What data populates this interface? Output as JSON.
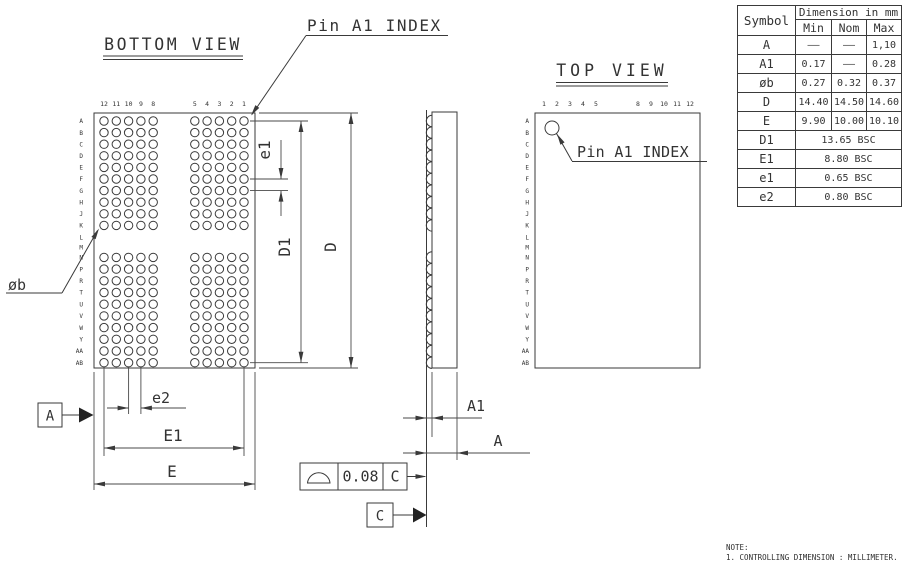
{
  "drawing": {
    "bottom_view_title": "BOTTOM VIEW",
    "top_view_title": "TOP VIEW",
    "pin_a1_index_bottom": "Pin A1 INDEX",
    "pin_a1_index_top": "Pin A1 INDEX",
    "ball_diameter_label": "øb",
    "dims": {
      "e1": "e1",
      "e2": "e2",
      "E1": "E1",
      "E": "E",
      "D1": "D1",
      "D": "D",
      "A1": "A1",
      "A": "A"
    },
    "datums": {
      "a": "A",
      "c": "C"
    },
    "flatness_callout": {
      "tolerance": "0.08",
      "datum": "C"
    },
    "grid": {
      "row_labels": [
        "A",
        "B",
        "C",
        "D",
        "E",
        "F",
        "G",
        "H",
        "J",
        "K",
        "L",
        "M",
        "N",
        "P",
        "R",
        "T",
        "U",
        "V",
        "W",
        "Y",
        "AA",
        "AB"
      ],
      "bottom_col_labels": [
        "12",
        "11",
        "10",
        "9",
        "8",
        "5",
        "4",
        "3",
        "2",
        "1"
      ],
      "top_col_labels": [
        "1",
        "2",
        "3",
        "4",
        "5",
        "8",
        "9",
        "10",
        "11",
        "12"
      ]
    },
    "colors": {
      "ink": "#3a3a3a"
    }
  },
  "table": {
    "symbol_header": "Symbol",
    "dimension_header": "Dimension in mm",
    "col_headers": [
      "Min",
      "Nom",
      "Max"
    ],
    "rows": [
      {
        "symbol": "A",
        "min": "——",
        "nom": "——",
        "max": "1,10"
      },
      {
        "symbol": "A1",
        "min": "0.17",
        "nom": "——",
        "max": "0.28"
      },
      {
        "symbol": "øb",
        "min": "0.27",
        "nom": "0.32",
        "max": "0.37"
      },
      {
        "symbol": "D",
        "min": "14.40",
        "nom": "14.50",
        "max": "14.60"
      },
      {
        "symbol": "E",
        "min": "9.90",
        "nom": "10.00",
        "max": "10.10"
      },
      {
        "symbol": "D1",
        "span": "13.65 BSC"
      },
      {
        "symbol": "E1",
        "span": "8.80 BSC"
      },
      {
        "symbol": "e1",
        "span": "0.65 BSC"
      },
      {
        "symbol": "e2",
        "span": "0.80 BSC"
      }
    ]
  },
  "note": {
    "heading": "NOTE:",
    "line1": "1. CONTROLLING DIMENSION : MILLIMETER."
  }
}
